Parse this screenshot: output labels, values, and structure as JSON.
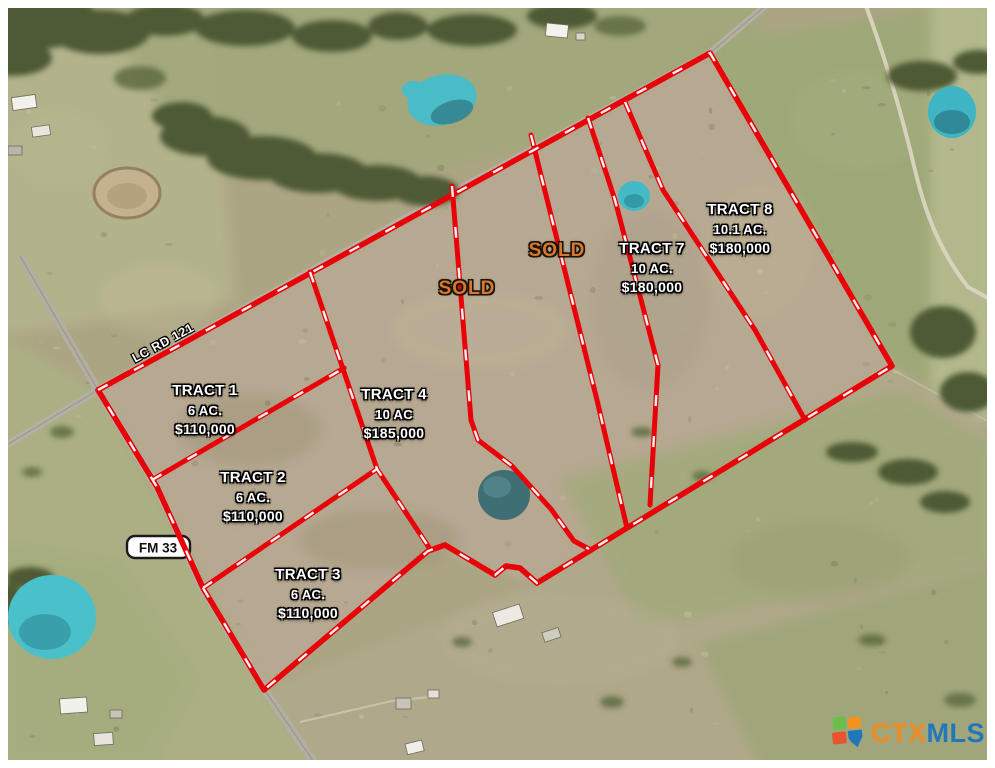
{
  "map": {
    "tracts": [
      {
        "name": "TRACT 1",
        "acreage": "6 AC.",
        "price": "$110,000"
      },
      {
        "name": "TRACT 2",
        "acreage": "6 AC.",
        "price": "$110,000"
      },
      {
        "name": "TRACT 3",
        "acreage": "6 AC.",
        "price": "$110,000"
      },
      {
        "name": "TRACT 4",
        "acreage": "10 AC",
        "price": "$185,000"
      },
      {
        "name": "TRACT 7",
        "acreage": "10 AC.",
        "price": "$180,000"
      },
      {
        "name": "TRACT 8",
        "acreage": "10.1 AC.",
        "price": "$180,000"
      }
    ],
    "sold_labels": [
      {
        "label": "SOLD"
      },
      {
        "label": "SOLD"
      }
    ],
    "roads": [
      {
        "label": "LC RD 121"
      },
      {
        "label": "FM 33"
      }
    ],
    "logo": {
      "ctx": "CTX",
      "mls": "MLS"
    },
    "colors": {
      "boundary_red": "#e90008",
      "dash_white": "#ffffff",
      "sold_orange": "#d9772e",
      "logo_orange": "#f28a21",
      "logo_blue": "#2176bc",
      "pond_teal": "#49bcc7"
    }
  }
}
